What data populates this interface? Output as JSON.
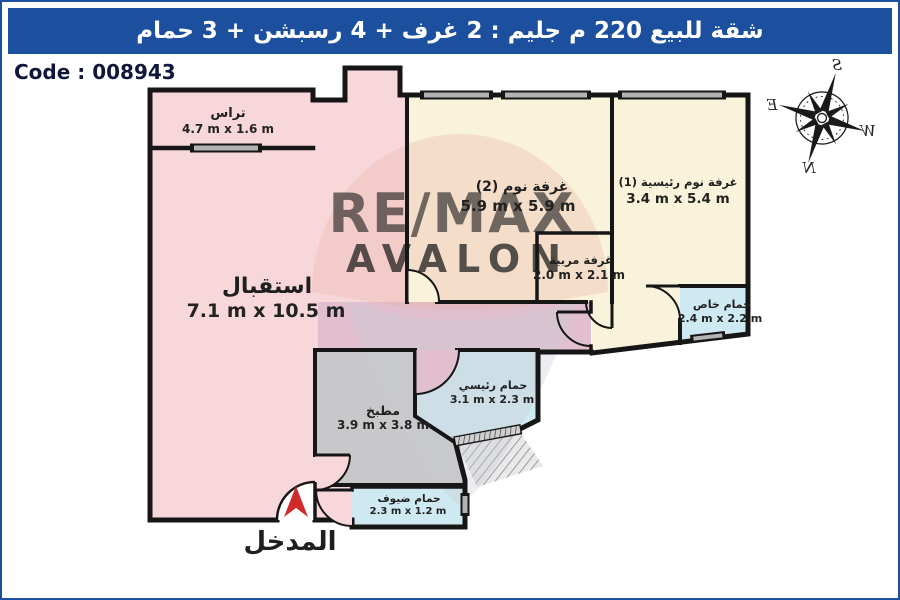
{
  "header": {
    "title": "شقة للبيع 220 م جليم : 2 غرف + 4 رسبشن + 3 حمام",
    "bg_color": "#1c4f9e",
    "text_color": "#ffffff"
  },
  "code_label": "Code : 008943",
  "watermark": {
    "line1": "RE/MAX",
    "line2": "AVALON"
  },
  "entrance": {
    "label": "المدخل",
    "arrow_color": "#d02b2b"
  },
  "compass": {
    "n": "N",
    "s": "S",
    "e": "E",
    "w": "W"
  },
  "colors": {
    "wall": "#161616",
    "reception_pink": "#f7d7da",
    "bedroom_cream": "#f8f3da",
    "bathroom_blue": "#cfe9f2",
    "kitchen_gray": "#c8c8ca",
    "corridor_mauve": "#e1bfce",
    "window_gray": "#b3b3b3",
    "watermark_red": "#ef9ea1",
    "watermark_gray": "#cfc5bb"
  },
  "rooms": [
    {
      "id": "terrace",
      "name": "تراس",
      "dims": "4.7 m x 1.6 m",
      "color": "#f7d7da"
    },
    {
      "id": "reception",
      "name": "استقبال",
      "dims": "7.1 m x 10.5 m",
      "color": "#f7d7da"
    },
    {
      "id": "bedroom-2",
      "name": "غرفة نوم (2)",
      "dims": "5.9 m x 5.9 m",
      "color": "#f8f3da"
    },
    {
      "id": "master-bedroom",
      "name": "غرفة نوم رئيسية (1)",
      "dims": "3.4 m x 5.4 m",
      "color": "#f8f3da"
    },
    {
      "id": "nanny-room",
      "name": "غرفة مربية",
      "dims": "2.0 m x 2.1 m",
      "color": "#f8f3da"
    },
    {
      "id": "private-bathroom",
      "name": "حمام خاص",
      "dims": "2.4 m x 2.2 m",
      "color": "#cfe9f2"
    },
    {
      "id": "main-bathroom",
      "name": "حمام رئيسي",
      "dims": "3.1 m x 2.3 m",
      "color": "#cfe9f2"
    },
    {
      "id": "kitchen",
      "name": "مطبخ",
      "dims": "3.9 m x 3.8 m",
      "color": "#c8c8ca"
    },
    {
      "id": "guest-bathroom",
      "name": "حمام ضيوف",
      "dims": "2.3 m x 1.2 m",
      "color": "#cfe9f2"
    }
  ]
}
